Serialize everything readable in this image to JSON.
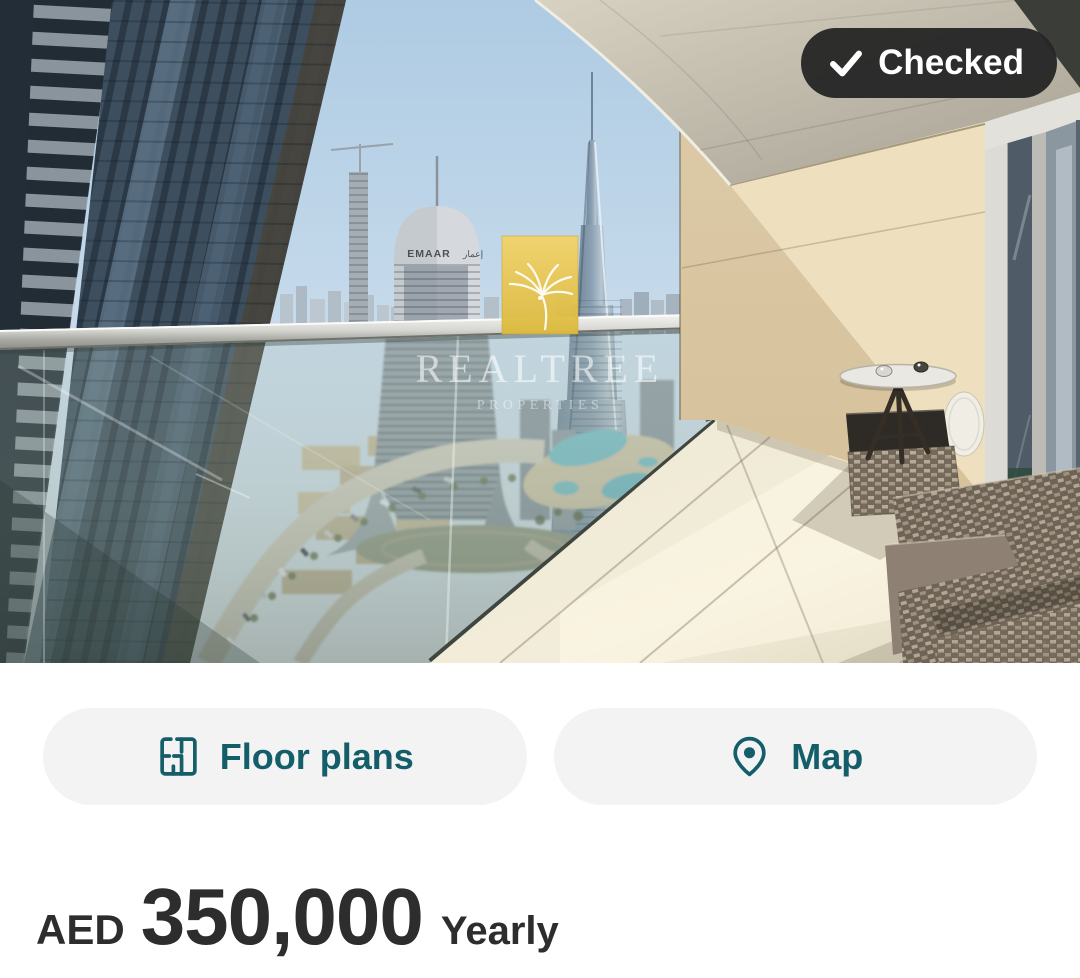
{
  "photo": {
    "badge": {
      "label": "Checked",
      "icon": "check-icon",
      "bg": "#282828"
    },
    "watermark": {
      "title": "REALTREE",
      "subtitle": "PROPERTIES",
      "gold": "#E8C452"
    },
    "signs": {
      "emaar": "EMAAR",
      "emaar_ar": "إعمار"
    }
  },
  "actions": {
    "floor_plans": {
      "label": "Floor plans",
      "icon": "floorplan-icon"
    },
    "map": {
      "label": "Map",
      "icon": "map-pin-icon"
    }
  },
  "price": {
    "currency": "AED",
    "amount": "350,000",
    "period": "Yearly"
  },
  "colors": {
    "accent": "#135E68",
    "button_bg": "#F3F3F4",
    "text": "#2D2D2D",
    "badge_bg": "#282828"
  }
}
